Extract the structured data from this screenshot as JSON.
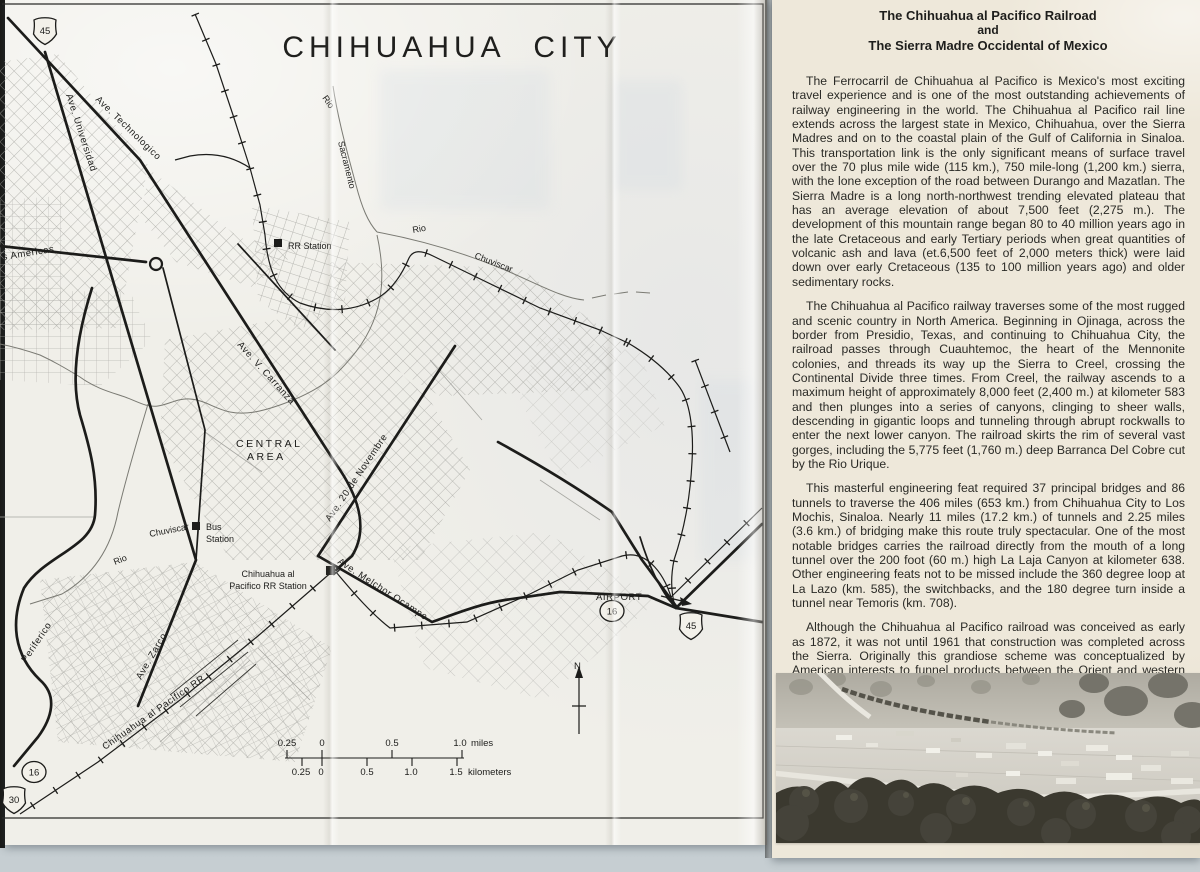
{
  "colors": {
    "scan_bg": "#cbd3d7",
    "map_paper": "#f0efe9",
    "article_paper": "#eee8da",
    "ink": "#1c1c1a"
  },
  "map": {
    "title": "CHIHUAHUA CITY",
    "roads": {
      "technologico": "Ave. Technologico",
      "universidad": "Ave. Universidad",
      "americas": "s Americas",
      "carranza": "Ave. V. Carranza",
      "novembre": "Ave. 20 de Novembre",
      "melchor_ocampo": "Ave. Melchor Ocampo",
      "zarco": "Ave. Zarco",
      "periferico": "Periferico",
      "airport": "AIRPORT"
    },
    "railroads": {
      "pacifico_rr": "Chihuahua al Pacifico RR"
    },
    "rivers": {
      "rio": "Rio",
      "sacramento": "Sacramento",
      "chuviscar": "Chuviscar"
    },
    "places": {
      "central_line1": "CENTRAL",
      "central_line2": "AREA",
      "rr_station": "RR Station",
      "bus_line1": "Bus",
      "bus_line2": "Station",
      "pacifico_station_line1": "Chihuahua al",
      "pacifico_station_line2": "Pacifico RR Station"
    },
    "shields": {
      "us45": "45",
      "mex16": "16",
      "us30": "30"
    },
    "compass": "N",
    "scale": {
      "miles": [
        "0.25",
        "0",
        "0.5",
        "1.0"
      ],
      "miles_unit": "miles",
      "kilometers": [
        "0.25",
        "0",
        "0.5",
        "1.0",
        "1.5"
      ],
      "km_unit": "kilometers"
    }
  },
  "article": {
    "title_line1": "The Chihuahua al Pacifico Railroad",
    "title_line2": "and",
    "title_line3": "The Sierra Madre Occidental of Mexico",
    "paragraphs": [
      "The Ferrocarril de Chihuahua al Pacifico is Mexico's most exciting travel experience and is one of the most outstanding achievements of railway engineering in the world. The Chihuahua al Pacifico rail line extends across the largest state in Mexico, Chihuahua, over the Sierra Madres and on to the coastal plain of the Gulf of California in Sinaloa. This transportation link is the only significant means of surface travel over the 70 plus mile wide (115 km.), 750 mile-long (1,200 km.) sierra, with the lone exception of the road between Durango and Mazatlan. The Sierra Madre is a long north-northwest trending elevated plateau that has an average elevation of about 7,500 feet (2,275 m.). The development of this mountain range began 80 to 40 million years ago in the late Cretaceous and early Tertiary periods when great quantities of volcanic ash and lava (et.6,500 feet of 2,000 meters thick) were laid down over early Cretaceous (135 to 100 million years ago) and older sedimentary rocks.",
      "The Chihuahua al Pacifico railway traverses some of the most rugged and scenic country in North America. Beginning in Ojinaga, across the border from Presidio, Texas, and continuing to Chihuahua City, the railroad passes through Cuauhtemoc, the heart of the Mennonite colonies, and threads its way up the Sierra to Creel, crossing the Continental Divide three times. From Creel, the railway ascends to a maximum height of approximately 8,000 feet (2,400 m.) at kilometer 583 and then plunges into a series of canyons, clinging to sheer walls, descending in gigantic loops and tunneling through abrupt rockwalls to enter the next lower canyon. The railroad skirts the rim of several vast gorges, including the 5,775 feet (1,760 m.) deep Barranca Del Cobre cut by the Rio Urique.",
      "This masterful engineering feat required 37 principal bridges and 86 tunnels to traverse the 406 miles (653 km.) from Chihuahua City to Los Mochis, Sinaloa. Nearly 11 miles (17.2 km.) of tunnels and 2.25 miles (3.6 km.) of bridging make this route truly spectacular. One of the most notable bridges carries the railroad directly from the mouth of a long tunnel over the 200 foot (60 m.) high La Laja Canyon at kilometer 638. Other engineering feats not to be missed include the 360 degree loop at La Lazo (km. 585), the switchbacks, and the 180 degree turn inside a tunnel near Temoris (km. 708).",
      "Although the Chihuahua al Pacifico railroad was conceived as early as 1872, it was not until 1961 that construction was completed across the Sierra. Originally this grandiose scheme was conceptualized by American interests to funnel products between the Orient and western South America, and agricultural centers in the interior of the United States. Inefficient management, financial problems, construction difficulties, completion of other transcontinental railroads, the Panama Canal, and the 1911-1915 Mexican Revolution delayed construction for all practical purposes until shortly before World War II when a roadbed was built across the gap between Creel and Choix. Within the next twenty years the railbed was bridged and put into use for its intended purpose."
    ]
  }
}
